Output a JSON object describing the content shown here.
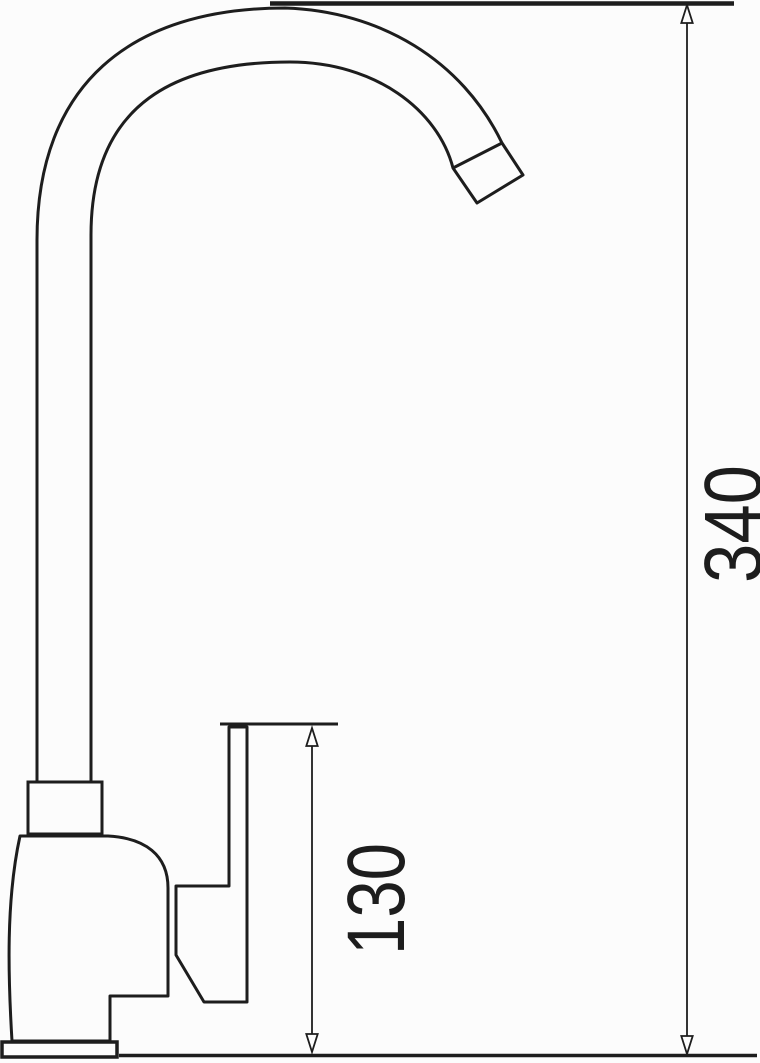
{
  "drawing": {
    "kind": "technical-dimension-drawing",
    "subject": "kitchen faucet side view",
    "background_color": "#fcfcfc",
    "line_color": "#1d1d1d",
    "dimension_labels": [
      {
        "id": "overall-height",
        "value": "340",
        "orientation": "vertical"
      },
      {
        "id": "handle-top-to-base-height",
        "value": "130",
        "orientation": "vertical"
      }
    ]
  }
}
